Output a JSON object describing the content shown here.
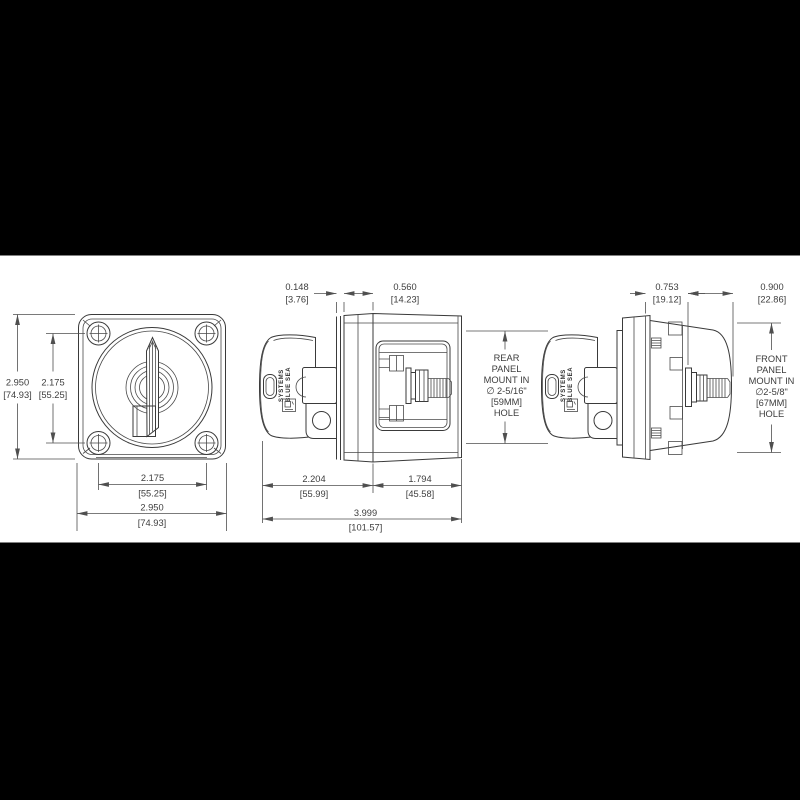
{
  "drawing_title": "battery-switch-dimension-drawing",
  "colors": {
    "background": "#000000",
    "paper": "#ffffff",
    "line": "#3a3a3a",
    "dimension_text": "#3d3d3d"
  },
  "front_view": {
    "dims": {
      "overall_height_in": "2.950",
      "overall_height_mm": "[74.93]",
      "hole_spacing_vertical_in": "2.175",
      "hole_spacing_vertical_mm": "[55.25]",
      "hole_spacing_horizontal_in": "2.175",
      "hole_spacing_horizontal_mm": "[55.25]",
      "overall_width_in": "2.950",
      "overall_width_mm": "[74.93]"
    }
  },
  "rear_mount_view": {
    "dims": {
      "panel_lip_in": "0.148",
      "panel_lip_mm": "[3.76]",
      "flange_depth_in": "0.560",
      "flange_depth_mm": "[14.23]",
      "knob_to_flange_in": "2.204",
      "knob_to_flange_mm": "[55.99]",
      "flange_to_stud_in": "1.794",
      "flange_to_stud_mm": "[45.58]",
      "overall_depth_in": "3.999",
      "overall_depth_mm": "[101.57]"
    },
    "note_lines": [
      "REAR",
      "PANEL",
      "MOUNT IN",
      "∅ 2-5/16\"",
      "[59MM]",
      "HOLE"
    ],
    "brand_line1": "BLUE SEA",
    "brand_line2": "SYSTEMS"
  },
  "front_mount_view": {
    "dims": {
      "flange_to_nut_in": "0.753",
      "flange_to_nut_mm": "[19.12]",
      "stud_length_in": "0.900",
      "stud_length_mm": "[22.86]"
    },
    "note_lines": [
      "FRONT",
      "PANEL",
      "MOUNT IN",
      "∅2-5/8\"",
      "[67MM]",
      "HOLE"
    ],
    "brand_line1": "BLUE SEA",
    "brand_line2": "SYSTEMS"
  }
}
